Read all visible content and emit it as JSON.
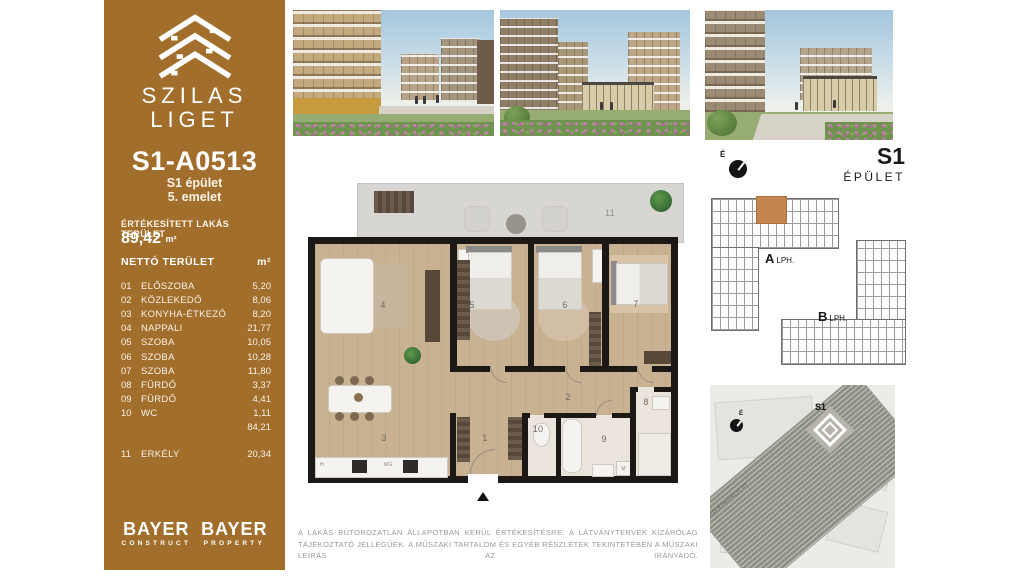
{
  "brand": {
    "line1": "SZILAS",
    "line2": "LIGET"
  },
  "unit": {
    "id": "S1-A0513",
    "building": "S1 épület",
    "floor": "5. emelet",
    "sold_area_label": "ÉRTÉKESÍTETT LAKÁS TERÜLET",
    "sold_area_value": "89,42",
    "area_unit": "m²"
  },
  "table": {
    "header": "NETTÓ TERÜLET",
    "unit": "m²",
    "rows": [
      {
        "no": "01",
        "name": "ELŐSZOBA",
        "area": "5,20"
      },
      {
        "no": "02",
        "name": "KÖZLEKEDŐ",
        "area": "8,06"
      },
      {
        "no": "03",
        "name": "KONYHA-ÉTKEZŐ",
        "area": "8,20"
      },
      {
        "no": "04",
        "name": "NAPPALI",
        "area": "21,77"
      },
      {
        "no": "05",
        "name": "SZOBA",
        "area": "10,05"
      },
      {
        "no": "06",
        "name": "SZOBA",
        "area": "10,28"
      },
      {
        "no": "07",
        "name": "SZOBA",
        "area": "11,80"
      },
      {
        "no": "08",
        "name": "FÜRDŐ",
        "area": "3,37"
      },
      {
        "no": "09",
        "name": "FÜRDŐ",
        "area": "4,41"
      },
      {
        "no": "10",
        "name": "WC",
        "area": "1,11"
      }
    ],
    "subtotal": "84,21",
    "extra_row": {
      "no": "11",
      "name": "ERKÉLY",
      "area": "20,34"
    }
  },
  "floor_plan": {
    "room_numbers": {
      "r1": "1",
      "r2": "2",
      "r3": "3",
      "r4": "4",
      "r5": "5",
      "r6": "6",
      "r7": "7",
      "r8": "8",
      "r9": "9",
      "r10": "10",
      "r11": "11"
    },
    "labels": {
      "hob": "H",
      "dishwasher": "MG",
      "washer": "M"
    }
  },
  "building_plan": {
    "title": "S1",
    "subtitle": "ÉPÜLET",
    "north": "É",
    "stair_a": "A",
    "stair_a_suffix": "LPH.",
    "stair_b": "B",
    "stair_b_suffix": "LPH."
  },
  "site_map": {
    "label": "S1",
    "street": "SZENTMIHÁLYI ÚT",
    "north": "É"
  },
  "footer": {
    "logo1_name": "BAYER",
    "logo1_sub": "CONSTRUCT",
    "logo2_name": "BAYER",
    "logo2_sub": "PROPERTY"
  },
  "disclaimer": "A LAKÁS BÚTOROZATLAN ÁLLAPOTBAN KERÜL ÉRTÉKESÍTÉSRE. A LÁTVÁNYTERVEK KIZÁRÓLAG TÁJÉKOZTATÓ JELLEGŰEK. A MŰSZAKI TARTALOM ÉS EGYÉB RÉSZLETEK TEKINTETÉBEN A MŰSZAKI LEÍRÁS AZ IRÁNYADÓ.",
  "colors": {
    "brand_brown": "#A26E2C",
    "unit_highlight": "#C6854E",
    "wall_black": "#1B1815",
    "wood_floor": "#C9B292",
    "balcony_gray": "#D7D6D3"
  }
}
